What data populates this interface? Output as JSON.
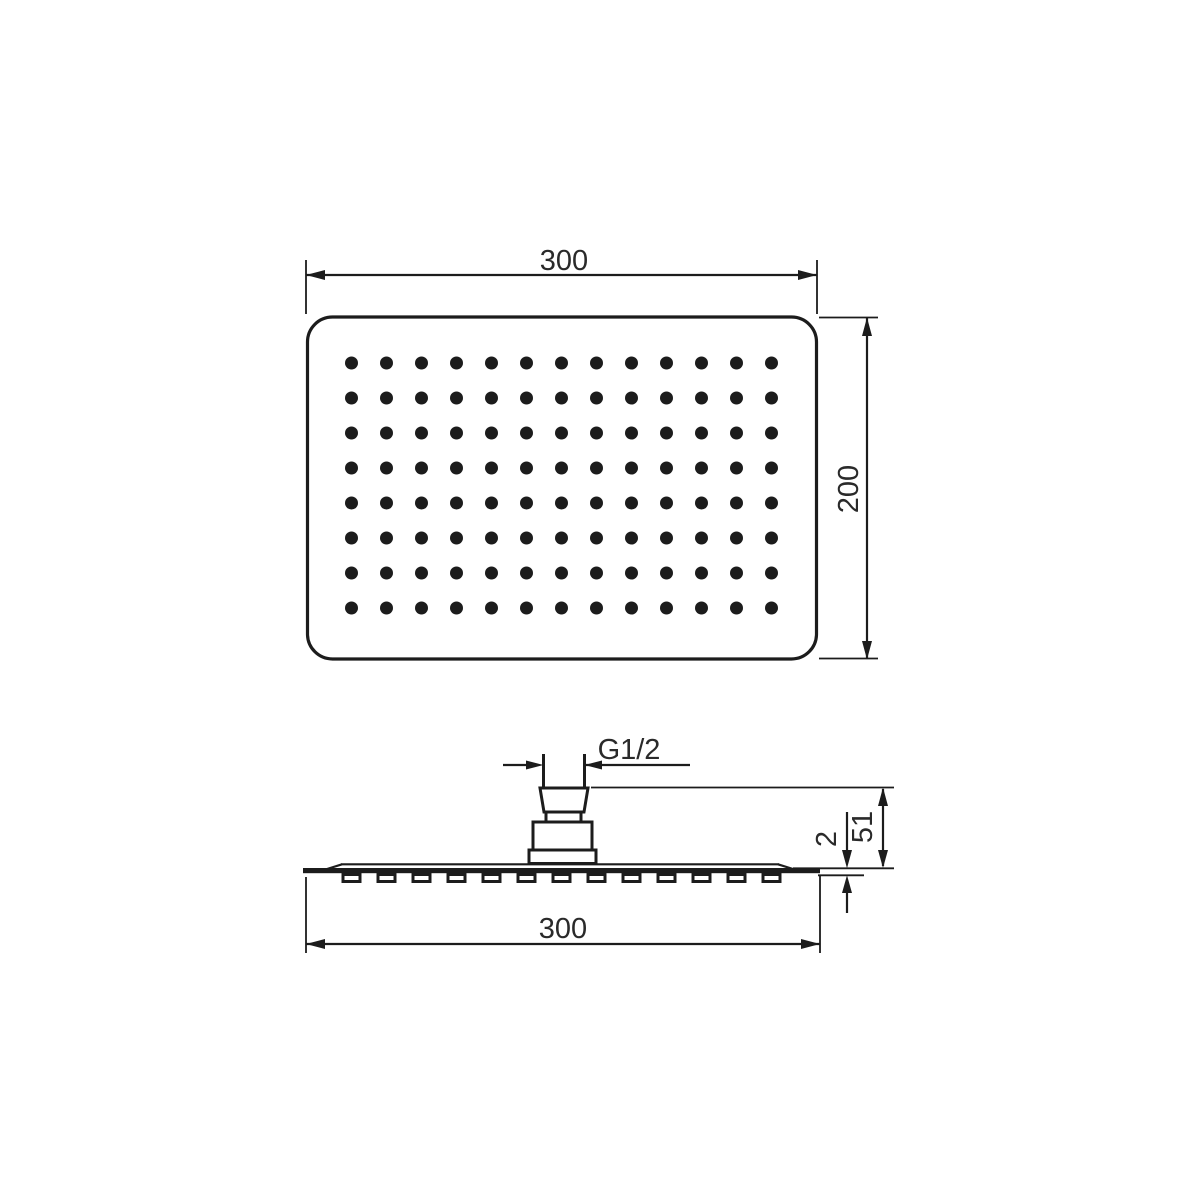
{
  "page": {
    "background_color": "#ffffff",
    "line_color": "#1c1c1c",
    "text_color": "#2a2a2a",
    "description": "technical dimension drawing of rectangular overhead shower head, top view and side view"
  },
  "views": {
    "top": {
      "name": "top-view",
      "width_dim": "300",
      "height_dim": "200",
      "grid": {
        "cols": 13,
        "rows": 8
      }
    },
    "side": {
      "name": "side-view",
      "thread_dim": "G1/2",
      "height_dim": "51",
      "plate_thickness_dim": "2",
      "width_dim": "300",
      "nozzle_count": 13
    }
  }
}
